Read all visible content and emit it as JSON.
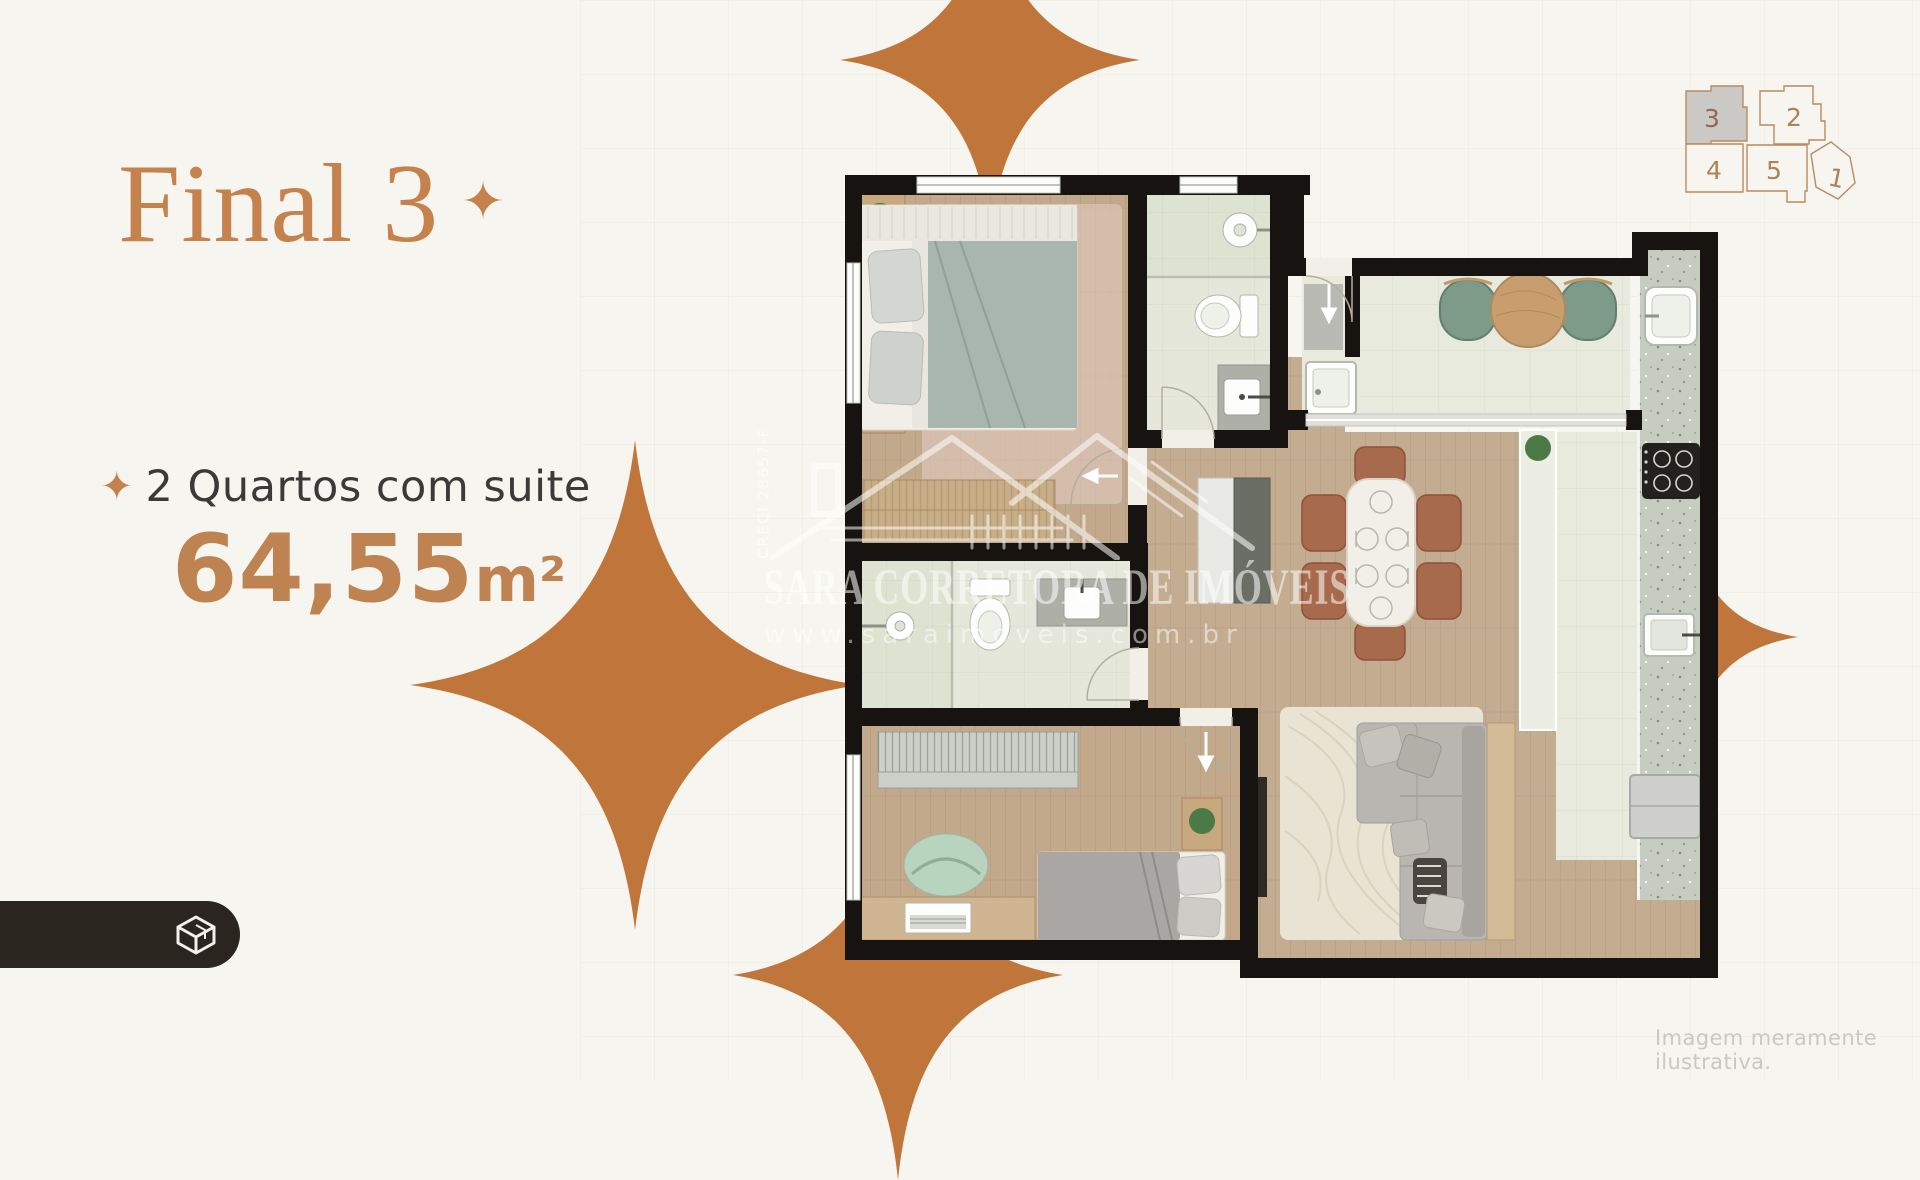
{
  "panel": {
    "title": "Final 3",
    "title_star": "✦",
    "feature_star": "✦",
    "feature": "2 Quartos com suite",
    "area_value": "64,55",
    "area_unit": "m²"
  },
  "watermark": {
    "creci": "CRECI 28657-F",
    "brand": "SARA CORRETORA DE IMÓVEIS",
    "site": "www.saraimoveis.com.br"
  },
  "keyplan": {
    "units": [
      {
        "label": "3",
        "highlighted": true
      },
      {
        "label": "2",
        "highlighted": false
      },
      {
        "label": "4",
        "highlighted": false
      },
      {
        "label": "5",
        "highlighted": false
      },
      {
        "label": "1",
        "highlighted": false
      }
    ]
  },
  "caption": "Imagem meramente ilustrativa.",
  "colors": {
    "background": "#f7f5ef",
    "accent_copper": "#c5824d",
    "area_copper": "#bf8351",
    "star_orange": "#c0763a",
    "dark_text": "#3b3a38",
    "pill_dark": "#2a251f",
    "caption_gray": "#c9c8c4",
    "keyplan_outline": "#bc8a5e",
    "keyplan_highlight": "#cbc9c5",
    "wall_black": "#171310"
  }
}
